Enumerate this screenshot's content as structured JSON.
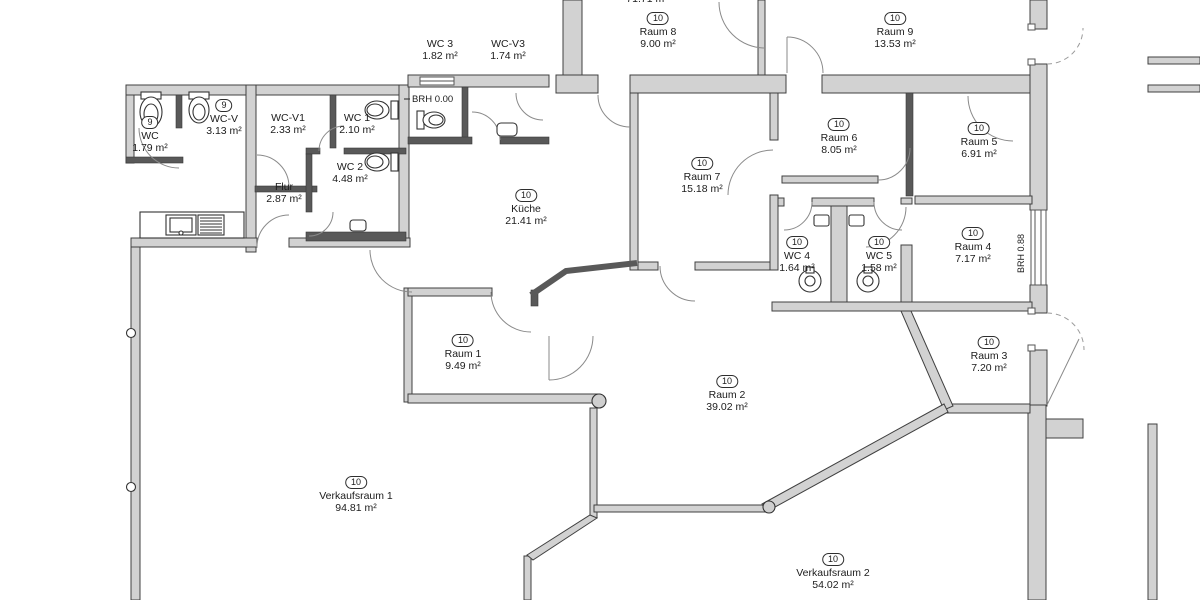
{
  "colors": {
    "background": "#ffffff",
    "wall_fill": "#d2d2d2",
    "wall_stroke": "#404040",
    "thin_wall": "#595959",
    "door_arc": "#8a8a8a",
    "text": "#1c1c1c"
  },
  "annotations": {
    "brh_zero": "BRH 0.00",
    "brh_window": "BRH 0.88",
    "top_clipped": "71.71 m²"
  },
  "rooms": [
    {
      "id": "wc",
      "badge": "9",
      "name": "WC",
      "area": "1.79 m²"
    },
    {
      "id": "wc-v",
      "badge": "9",
      "name": "WC-V",
      "area": "3.13 m²"
    },
    {
      "id": "wc-v1",
      "badge": "",
      "name": "WC-V1",
      "area": "2.33 m²"
    },
    {
      "id": "wc-1",
      "badge": "",
      "name": "WC 1",
      "area": "2.10 m²"
    },
    {
      "id": "wc-2",
      "badge": "",
      "name": "WC 2",
      "area": "4.48 m²"
    },
    {
      "id": "flur",
      "badge": "",
      "name": "Flur",
      "area": "2.87 m²"
    },
    {
      "id": "wc-3",
      "badge": "",
      "name": "WC 3",
      "area": "1.82 m²"
    },
    {
      "id": "wc-v3",
      "badge": "",
      "name": "WC-V3",
      "area": "1.74 m²"
    },
    {
      "id": "raum-8",
      "badge": "10",
      "name": "Raum 8",
      "area": "9.00 m²"
    },
    {
      "id": "raum-9",
      "badge": "10",
      "name": "Raum 9",
      "area": "13.53 m²"
    },
    {
      "id": "raum-6",
      "badge": "10",
      "name": "Raum 6",
      "area": "8.05 m²"
    },
    {
      "id": "raum-5",
      "badge": "10",
      "name": "Raum 5",
      "area": "6.91 m²"
    },
    {
      "id": "raum-7",
      "badge": "10",
      "name": "Raum 7",
      "area": "15.18 m²"
    },
    {
      "id": "kueche",
      "badge": "10",
      "name": "Küche",
      "area": "21.41 m²"
    },
    {
      "id": "wc-4",
      "badge": "10",
      "name": "WC 4",
      "area": "1.64 m²"
    },
    {
      "id": "wc-5",
      "badge": "10",
      "name": "WC 5",
      "area": "1.58 m²"
    },
    {
      "id": "raum-4",
      "badge": "10",
      "name": "Raum 4",
      "area": "7.17 m²"
    },
    {
      "id": "raum-1",
      "badge": "10",
      "name": "Raum 1",
      "area": "9.49 m²"
    },
    {
      "id": "raum-3",
      "badge": "10",
      "name": "Raum 3",
      "area": "7.20 m²"
    },
    {
      "id": "raum-2",
      "badge": "10",
      "name": "Raum 2",
      "area": "39.02 m²"
    },
    {
      "id": "verkaufsraum-1",
      "badge": "10",
      "name": "Verkaufsraum 1",
      "area": "94.81 m²"
    },
    {
      "id": "verkaufsraum-2",
      "badge": "10",
      "name": "Verkaufsraum 2",
      "area": "54.02 m²"
    }
  ],
  "fixtures": [
    {
      "icon": "toilet-icon"
    },
    {
      "icon": "toilet-icon"
    },
    {
      "icon": "toilet-icon"
    },
    {
      "icon": "toilet-icon"
    },
    {
      "icon": "toilet-icon"
    },
    {
      "icon": "wall-toilet-icon"
    },
    {
      "icon": "wall-toilet-icon"
    },
    {
      "icon": "washbasin-icon"
    },
    {
      "icon": "washbasin-icon"
    },
    {
      "icon": "cistern-icon"
    },
    {
      "icon": "cistern-icon"
    },
    {
      "icon": "kitchen-sink-counter-icon"
    },
    {
      "icon": "column-icon"
    },
    {
      "icon": "column-icon"
    },
    {
      "icon": "window-icon"
    },
    {
      "icon": "window-icon"
    },
    {
      "icon": "door-swing-icon"
    }
  ]
}
